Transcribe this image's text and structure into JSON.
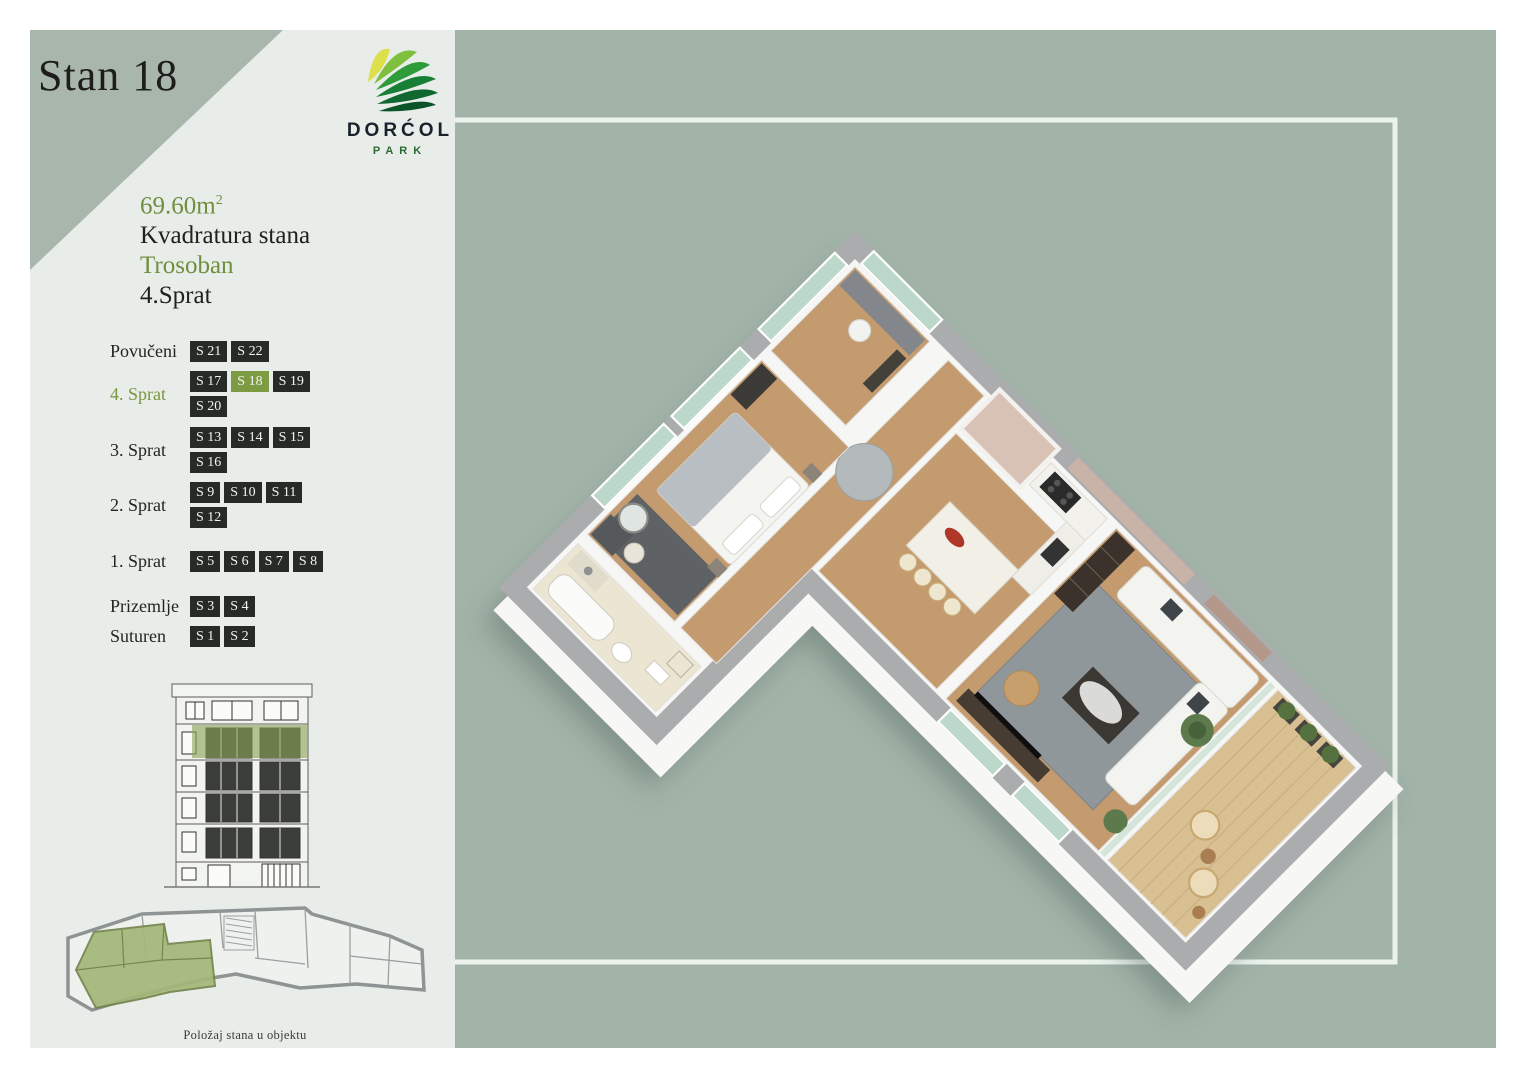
{
  "title": "Stan 18",
  "logo": {
    "name": "DORĆOL",
    "sub": "PARK"
  },
  "info": {
    "area_base": "69.60m",
    "area_sup": "2",
    "area_label": "Kvadratura stana",
    "type": "Trosoban",
    "floor": "4.Sprat"
  },
  "floors": [
    {
      "label": "Povučeni",
      "highlight": false,
      "units": [
        "S 21",
        "S 22"
      ]
    },
    {
      "label": "4. Sprat",
      "highlight": true,
      "units": [
        "S 17",
        "S 18",
        "S 19",
        "S 20"
      ],
      "active_unit": "S 18"
    },
    {
      "label": "3. Sprat",
      "highlight": false,
      "units": [
        "S 13",
        "S 14",
        "S 15",
        "S 16"
      ]
    },
    {
      "label": "2. Sprat",
      "highlight": false,
      "units": [
        "S 9",
        "S 10",
        "S 11",
        "S 12"
      ]
    },
    {
      "label": "1. Sprat",
      "highlight": false,
      "units": [
        "S 5",
        "S 6",
        "S 7",
        "S 8"
      ]
    },
    {
      "label": "Prizemlje",
      "highlight": false,
      "units": [
        "S 3",
        "S 4"
      ]
    },
    {
      "label": "Suturen",
      "highlight": false,
      "units": [
        "S 1",
        "S 2"
      ]
    }
  ],
  "footprint_caption": "Položaj stana u objektu",
  "colors": {
    "accent_green": "#7d9b42",
    "info_green": "#6f8f3f",
    "chip_bg": "#272b27",
    "left_panel_bg": "#e8ede9",
    "corner_triangle": "#a9b6ab",
    "right_panel_bg": "#a2b3a8",
    "frame_line": "#ecf3ed",
    "wall_gray": "#abacae",
    "wood_floor": "#c49a6f"
  }
}
